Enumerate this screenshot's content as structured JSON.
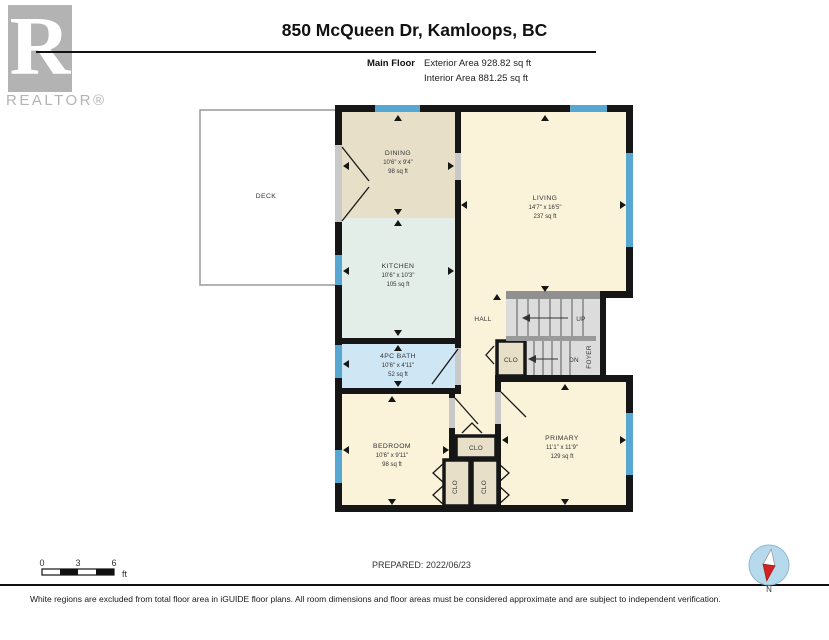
{
  "header": {
    "logo_letter": "R",
    "logo_text": "REALTOR®",
    "title": "850 McQueen Dr, Kamloops, BC",
    "floor_label": "Main Floor",
    "exterior_area": "Exterior Area 928.82 sq ft",
    "interior_area": "Interior Area 881.25 sq ft"
  },
  "plan": {
    "deck": {
      "name": "DECK"
    },
    "dining": {
      "name": "DINING",
      "dims": "10'6\" x 9'4\"",
      "area": "98 sq ft"
    },
    "kitchen": {
      "name": "KITCHEN",
      "dims": "10'6\" x 10'3\"",
      "area": "105 sq ft"
    },
    "living": {
      "name": "LIVING",
      "dims": "14'7\" x 16'5\"",
      "area": "237 sq ft"
    },
    "bath": {
      "name": "4PC BATH",
      "dims": "10'6\" x 4'11\"",
      "area": "52 sq ft"
    },
    "bedroom": {
      "name": "BEDROOM",
      "dims": "10'6\" x 9'11\"",
      "area": "98 sq ft"
    },
    "primary": {
      "name": "PRIMARY",
      "dims": "11'1\" x 11'9\"",
      "area": "129 sq ft"
    },
    "hall": {
      "name": "HALL"
    },
    "foyer": {
      "name": "FOYER"
    },
    "stairs_up": "UP",
    "stairs_down": "DN",
    "closet": "CLO"
  },
  "scale_bar": {
    "tick0": "0",
    "tick1": "3",
    "tick2": "6",
    "unit": "ft"
  },
  "compass": {
    "label": "N"
  },
  "footer": {
    "prepared": "PREPARED: 2022/06/23",
    "disclaimer": "White regions are excluded from total floor area in iGUIDE floor plans. All room dimensions and floor areas must be considered approximate and are subject to independent verification."
  },
  "colors": {
    "wall": "#161616",
    "window": "#57a7d3",
    "room_cream": "#faf3da",
    "room_beige": "#e7dfc8",
    "room_mint": "#e3eee8",
    "room_bath_blue": "#cfe7f4",
    "stairs_gray": "#dcdcdc",
    "logo_gray": "#b3b3b3"
  }
}
